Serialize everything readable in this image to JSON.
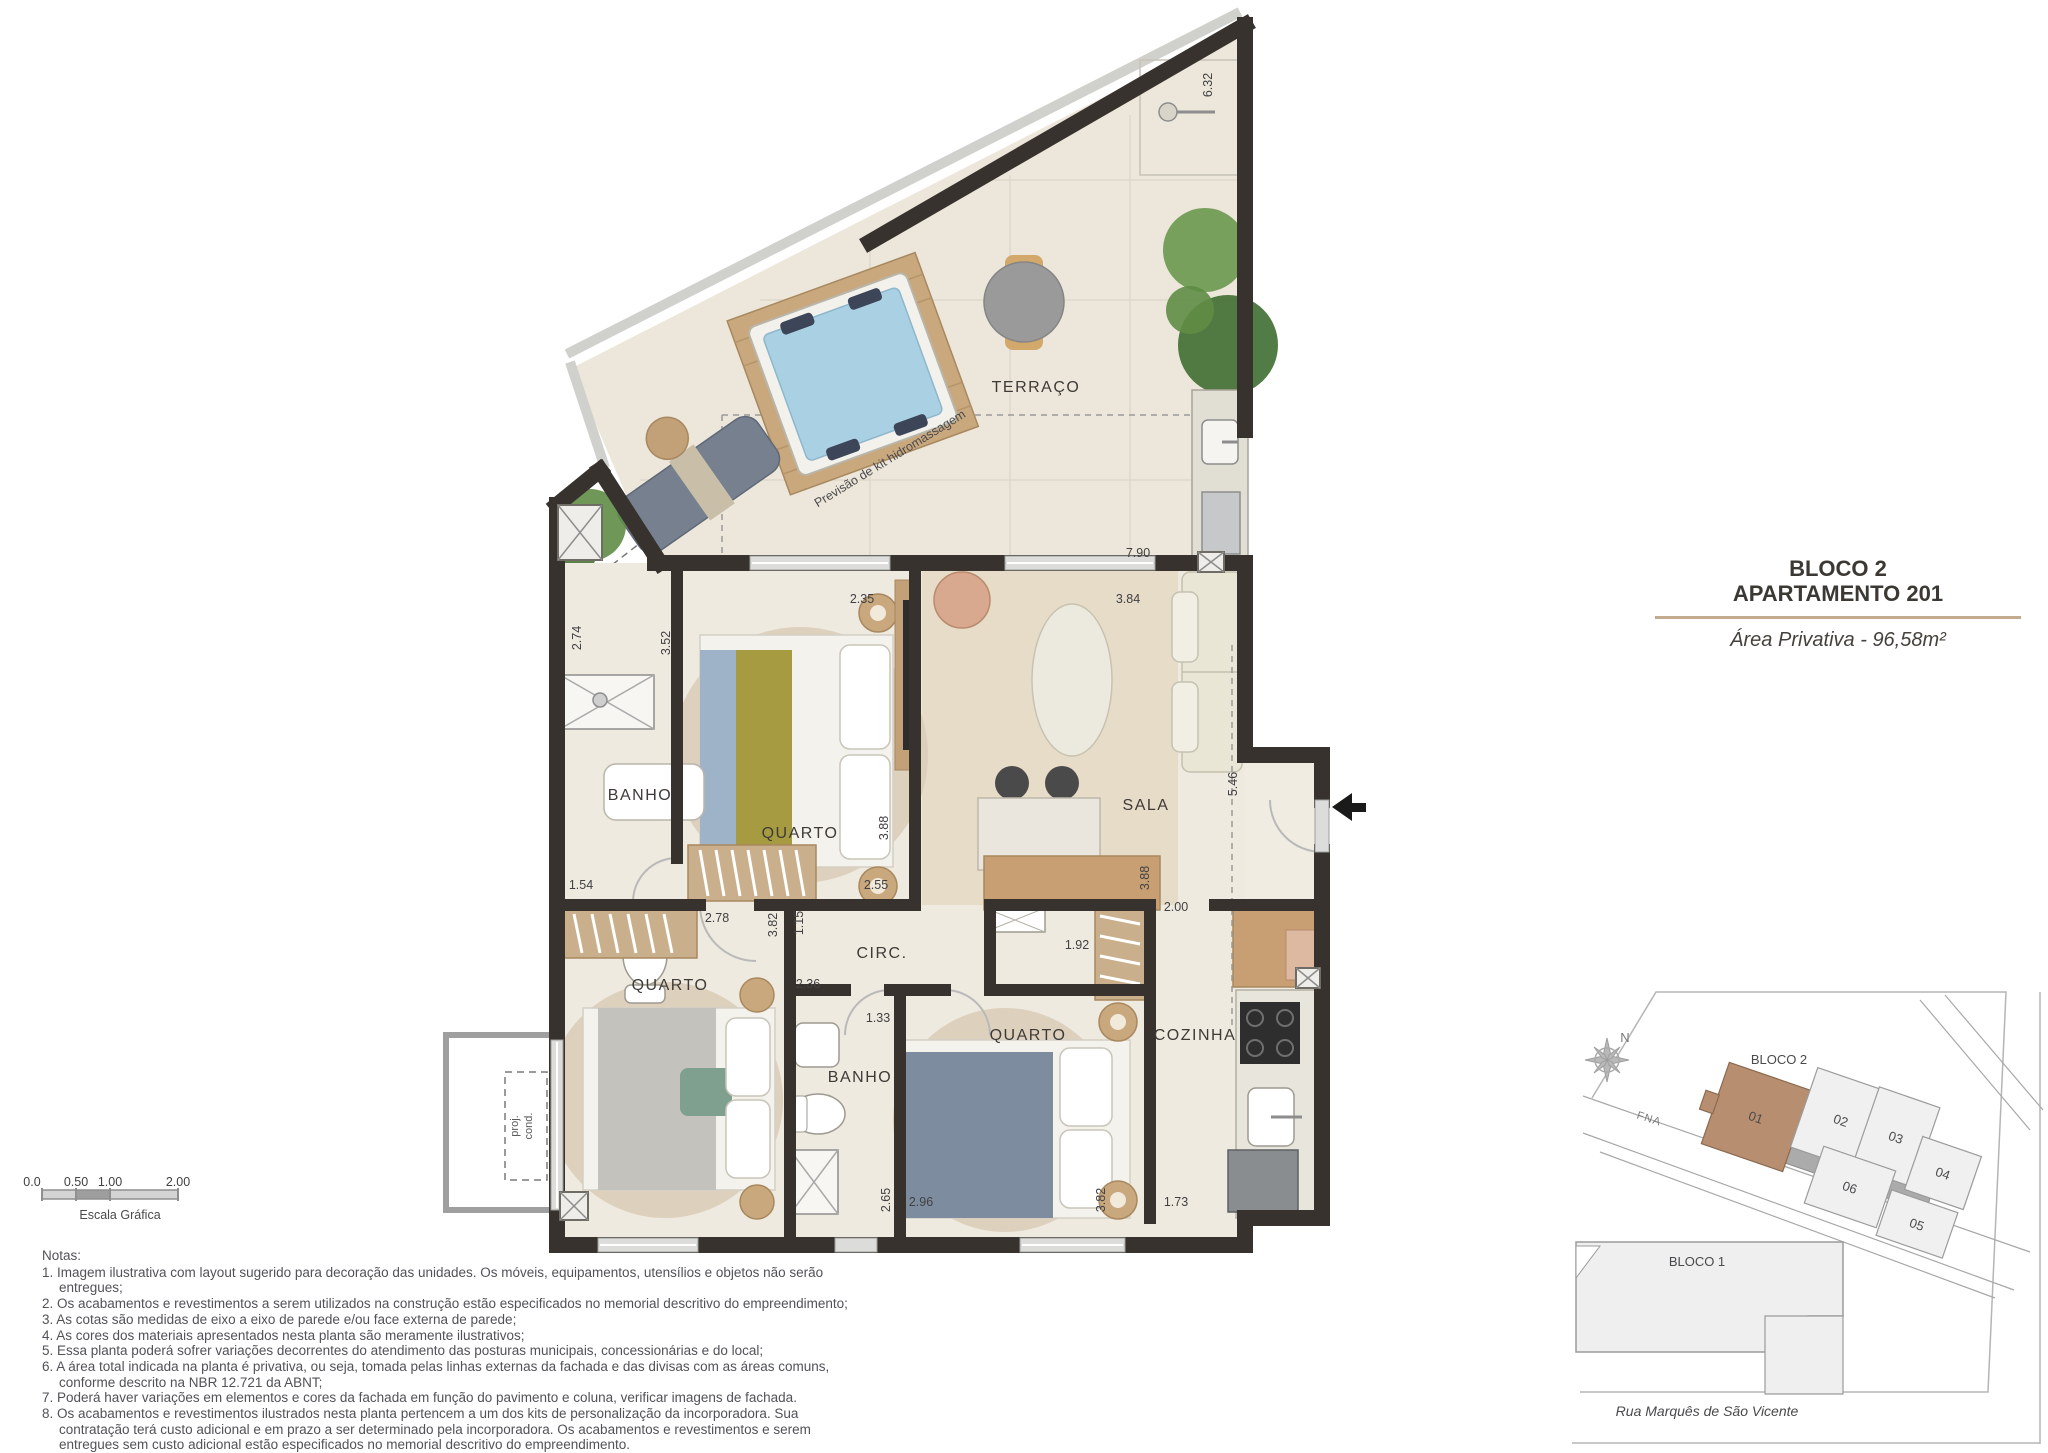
{
  "title_block": {
    "building": "BLOCO 2",
    "unit": "APARTAMENTO 201",
    "area": "Área Privativa - 96,58m²"
  },
  "floorplan": {
    "rooms": {
      "terraco": "TERRAÇO",
      "banho1": "BANHO",
      "quarto1": "QUARTO",
      "sala": "SALA",
      "quarto2": "QUARTO",
      "circ": "CIRC.",
      "banho2": "BANHO",
      "quarto3": "QUARTO",
      "cozinha": "COZINHA"
    },
    "annotations": {
      "hidro": "Previsão de kit hidromassagem",
      "proj_line1": "proj.",
      "proj_line2": "cond."
    },
    "dims": {
      "terrace_right": "6.32",
      "terrace_depth": "7.90",
      "quarto1_width": "2.35",
      "sala_width": "3.84",
      "terrace_left": "2.74",
      "banho1_height": "3.52",
      "quarto1_height": "3.88",
      "banho1_width": "1.54",
      "quarto1_bottom": "2.55",
      "quarto2_width": "2.78",
      "hall_height": "3.82",
      "hall_width": "1.15",
      "circ_width": "2.36",
      "banho2_width": "1.33",
      "closet_width": "1.92",
      "entry_width": "2.00",
      "sala_height": "3.88",
      "entry_height": "5.46",
      "banho2_height": "2.65",
      "quarto3_width": "2.96",
      "quarto3_height": "3.82",
      "cozinha_width": "1.73"
    }
  },
  "scale_bar": {
    "ticks": [
      "0.0",
      "0.50",
      "1.00",
      "2.00"
    ],
    "label": "Escala Gráfica"
  },
  "notes": {
    "heading": "Notas:",
    "items": [
      "1. Imagem ilustrativa com layout sugerido para decoração das unidades. Os móveis, equipamentos, utensílios e objetos não serão entregues;",
      "2. Os acabamentos e revestimentos a serem utilizados na construção estão especificados no memorial descritivo do empreendimento;",
      "3. As cotas são medidas de eixo a eixo de parede e/ou face externa de parede;",
      "4. As cores dos materiais apresentados nesta planta são meramente ilustrativos;",
      "5. Essa planta poderá sofrer variações decorrentes do atendimento das posturas municipais, concessionárias e do local;",
      "6. A área total indicada na planta é privativa, ou seja, tomada pelas linhas externas da fachada e das divisas com as áreas comuns, conforme descrito na NBR 12.721 da ABNT;",
      "7. Poderá haver variações em elementos e cores da fachada em função do pavimento e coluna, verificar imagens de fachada.",
      "8. Os acabamentos e revestimentos ilustrados nesta planta pertencem a um dos kits de personalização da incorporadora. Sua contratação terá custo adicional e em prazo a ser determinado pela incorporadora. Os acabamentos e revestimentos e serem entregues sem custo adicional estão especificados  no memorial descritivo do empreendimento."
    ]
  },
  "site_plan": {
    "north_label": "N",
    "bloco2_label": "BLOCO 2",
    "bloco1_label": "BLOCO 1",
    "road_label": "FNA",
    "street_label": "Rua Marquês de São Vicente",
    "units": [
      "01",
      "02",
      "03",
      "04",
      "05",
      "06"
    ]
  },
  "colors": {
    "wall": "#37322d",
    "accent_rule": "#c3ab90",
    "unit_highlight": "#b78e6f",
    "water": "#a9d1e3"
  }
}
